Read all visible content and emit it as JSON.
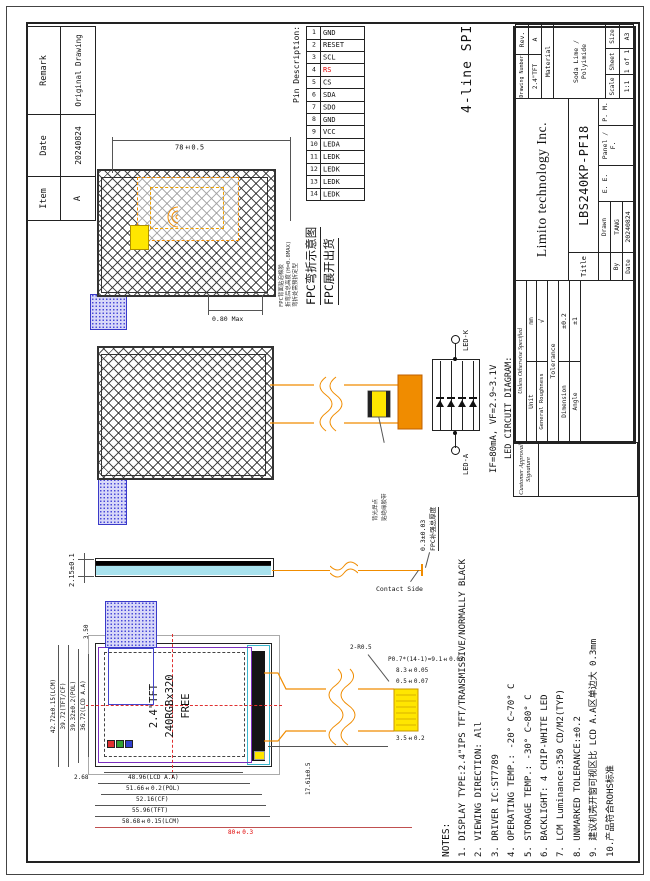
{
  "revision_table": {
    "headers": [
      "Item",
      "Date",
      "Remark"
    ],
    "row": [
      "A",
      "20240824",
      "Original Drawing"
    ]
  },
  "pin_table": {
    "title": "Pin Description:",
    "rs_color": "#e00000",
    "pins": [
      {
        "no": "1",
        "name": "GND"
      },
      {
        "no": "2",
        "name": "RESET"
      },
      {
        "no": "3",
        "name": "SCL"
      },
      {
        "no": "4",
        "name": "RS"
      },
      {
        "no": "5",
        "name": "CS"
      },
      {
        "no": "6",
        "name": "SDA"
      },
      {
        "no": "7",
        "name": "SDO"
      },
      {
        "no": "8",
        "name": "GND"
      },
      {
        "no": "9",
        "name": "VCC"
      },
      {
        "no": "10",
        "name": "LEDA"
      },
      {
        "no": "11",
        "name": "LEDK"
      },
      {
        "no": "12",
        "name": "LEDK"
      },
      {
        "no": "13",
        "name": "LEDK"
      },
      {
        "no": "14",
        "name": "LEDK"
      }
    ]
  },
  "interface_label": "4-line SPI",
  "fpc_fold_view": {
    "unfold_dim": "78±0.5",
    "fold_height": "0.80 Max",
    "note_lines": [
      "FPC背面贴泡棉胶",
      "折弯后总高度(H=0.8MAX)",
      "弯折处需预折定型"
    ],
    "captions": [
      "FPC弯折示意图",
      "FPC展开出货"
    ]
  },
  "fpc_flat_view": {
    "callout_lines": [
      "背光焊点",
      "贴绝缘胶带"
    ]
  },
  "side_view": {
    "thickness": "2.15±0.1",
    "contact_side": "Contact Side",
    "stiffener_thickness": "0.3±0.03",
    "stiffener_label": "FPC补强总厚度"
  },
  "led_circuit": {
    "anode_label": "LED-A",
    "cathode_label": "LED-K",
    "spec": "IF=80mA, VF=2.9~3.1V",
    "caption": "LED CIRCUIT DIAGRAM:"
  },
  "front_view": {
    "screen_lines": [
      "2.4\"TFT",
      "240RGBx320",
      "FREE"
    ],
    "length_dims": [
      "48.96(LCD A.A)",
      "51.66±0.2(POL)",
      "52.16(CF)",
      "55.96(TFT)",
      "58.68±0.15(LCM)"
    ],
    "overall_length_dim": "80±0.3",
    "width_dims": [
      "36.72(LCD A.A)",
      "39.32±0.2(POL)",
      "39.72(TFT/CF)",
      "42.72±0.15(LCM)"
    ],
    "edge_dim": "2.68",
    "tab_dim": "3.50",
    "fpc": {
      "length": "17.61±0.5",
      "contact_len": "3.5±0.2",
      "corner": "2-R0.5",
      "pad": "0.5±0.07",
      "contact_width": "8.3±0.05",
      "pitch": "P0.7*(14-1)=9.1±0.05"
    }
  },
  "notes": {
    "heading": "NOTES:",
    "items": [
      "1. DISPLAY TYPE:2.4\"IPS TFT/TRANSMISSIVE/NORMALLY BLACK",
      "2. VIEWING DIRECTION: All",
      "3. DRIVER IC:ST7789",
      "4. OPERATING TEMP.:  -20° C~70° C",
      "5. STORAGE TEMP.:  -30° C~80° C",
      "6. BACKLIGHT: 4 CHIP-WHITE LED",
      "7. LCM Luminance:350 CD/M2(TYP)",
      "8. UNMARKED TOLERANCE:±0.2",
      "9. 建议机壳开窗可视区比 LCD A.A区单边大 0.3mm",
      "10.产品符合ROHS标准"
    ]
  },
  "title_block": {
    "company": "Limito technology Inc.",
    "title_label": "Title",
    "part_number": "LBS240KP-PF18",
    "drawing_number_label": "Drawing Number",
    "drawing_number": "2.4\"TFT",
    "rev_label": "Rev.",
    "rev": "A",
    "material_label": "Material",
    "material": "Soda Lime / Polyimide",
    "scale_label": "Scale",
    "scale": "1:1",
    "sheet_label": "Sheet",
    "sheet": "1 of 1",
    "size_label": "Size",
    "size": "A3",
    "unless_label": "Unless Otherwise Specified",
    "unit_label": "Unit",
    "unit": "mm",
    "roughness_label": "General Roughness",
    "roughness_symbol": "√",
    "tolerance_label": "Tolerance",
    "dimension_label": "Dimension",
    "dimension_tol": "±0.2",
    "angle_label": "Angle",
    "angle_tol": "±1",
    "by_label": "By",
    "date_label": "Date",
    "drawn_label": "Drawn",
    "drawn_by": "TANG",
    "drawn_date": "20240824",
    "ee_label": "E. E.",
    "panel_label": "Panel / F.",
    "pm_label": "P. M."
  },
  "customer_approval": {
    "line1": "Customer Approval",
    "line2": "Signature"
  },
  "colors": {
    "accent_red": "#e00000",
    "fpc_orange": "#f08c00",
    "pad_yellow": "#ffe600",
    "tab_blue": "#4848d8",
    "glass_cyan": "#a8e2ee",
    "pol_purple": "#7b2fbe"
  }
}
